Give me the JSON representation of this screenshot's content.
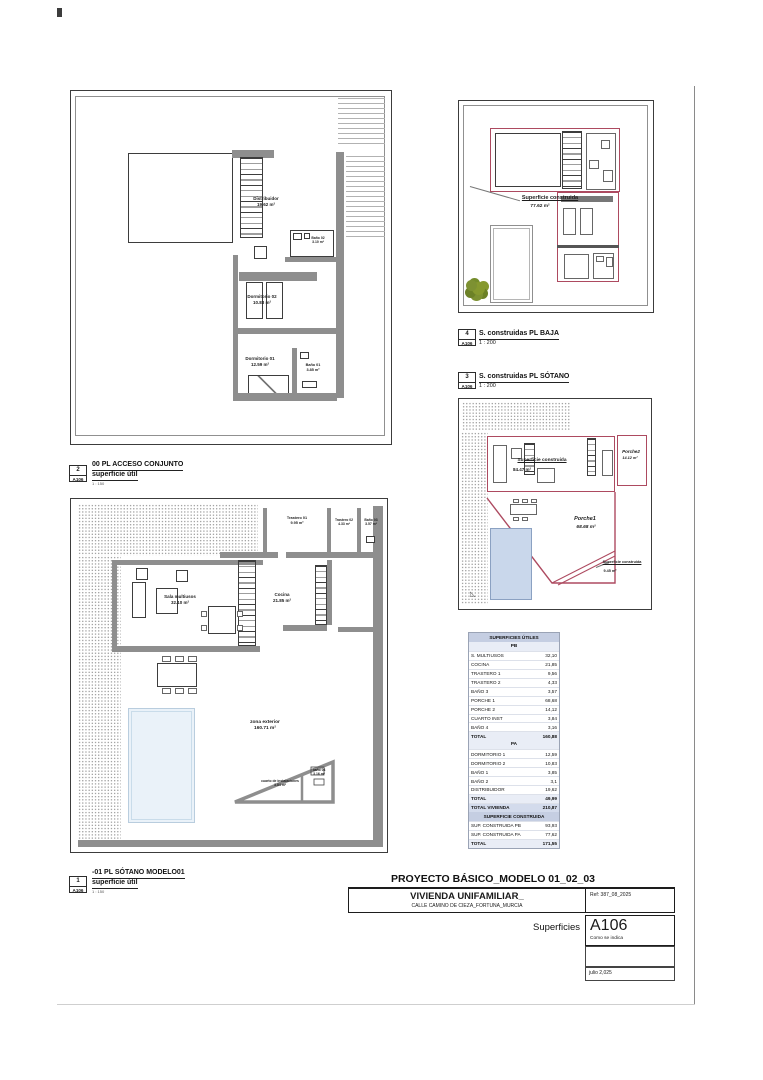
{
  "sheet": {
    "project_title": "PROYECTO BÁSICO_MODELO 01_02_03",
    "building_title": "VIVIENDA UNIFAMILIAR_",
    "address": "CALLE CAMINO DE CIEZA_FORTUNA_MURCIA",
    "reference": "Ref: 387_08_2025",
    "sheet_name": "Superficies",
    "sheet_number": "A106",
    "scale_note": "Como se indica",
    "date": "julio 2,025"
  },
  "view_labels": {
    "acceso": {
      "num": "2",
      "code": "A106",
      "title": "00 PL ACCESO CONJUNTO",
      "sub": "superficie útil",
      "scale": "1 : 150"
    },
    "sotano": {
      "num": "1",
      "code": "A106",
      "title": "-01 PL SÓTANO MODELO01",
      "sub": "superficie útil",
      "scale": "1 : 150"
    },
    "constr_baja": {
      "num": "4",
      "code": "A106",
      "title": "S. construidas PL BAJA",
      "scale": "1 : 200"
    },
    "constr_sotano": {
      "num": "3",
      "code": "A106",
      "title": "S. construidas PL SÓTANO",
      "scale": "1 : 200"
    }
  },
  "plans": {
    "acceso": {
      "rooms": {
        "distribuidor": {
          "name": "Distribuidor",
          "area": "19.62 m²"
        },
        "bano02": {
          "name": "Baño 02",
          "area": "3.10 m²"
        },
        "dormitorio02": {
          "name": "Dormitorio 02",
          "area": "10.83 m²"
        },
        "dormitorio01": {
          "name": "Dormitorio 01",
          "area": "12.59 m²"
        },
        "bano01": {
          "name": "Baño 01",
          "area": "3.85 m²"
        }
      }
    },
    "sotano": {
      "rooms": {
        "trastero01": {
          "name": "Trastero 01",
          "area": "9.95 m²"
        },
        "trastero02": {
          "name": "Trastero 02",
          "area": "4.33 m²"
        },
        "bano03": {
          "name": "Baño 03",
          "area": "3.57 m²"
        },
        "sala": {
          "name": "Sala multiusos",
          "area": "32.10 m²"
        },
        "cocina": {
          "name": "Cocina",
          "area": "21.85 m²"
        },
        "zona_exterior": {
          "name": "zona exterior",
          "area": "160.71 m²"
        },
        "cuarto_inst": {
          "name": "cuarto de instalaciones",
          "area": "3.84 m²"
        },
        "bano04": {
          "name": "baño 04",
          "area": "3.16 m²"
        }
      }
    },
    "baja_construida": {
      "label": "Superficie construida",
      "area": "77.62 m²"
    },
    "sotano_construida": {
      "construida": {
        "name": "Superficie construida",
        "area": "84.47 m²"
      },
      "porche2": {
        "name": "Porche2",
        "area": "14.12 m²"
      },
      "porche1": {
        "name": "Porche1",
        "area": "68.68 m²"
      },
      "construida2": {
        "name": "Superficie construida",
        "area": "9.45 m²"
      }
    }
  },
  "areas_table": {
    "title": "SUPERFICIES ÚTILES",
    "pb_header": "PB",
    "pb_rows": [
      {
        "label": "S. MULTIUSOS",
        "value": "32,10"
      },
      {
        "label": "COCINA",
        "value": "21,85"
      },
      {
        "label": "TRASTERO 1",
        "value": "9,56"
      },
      {
        "label": "TRASTERO 2",
        "value": "4,33"
      },
      {
        "label": "BAÑO 3",
        "value": "3,57"
      },
      {
        "label": "PORCHE 1",
        "value": "68,68"
      },
      {
        "label": "PORCHE 2",
        "value": "14,12"
      },
      {
        "label": "CUARTO INST",
        "value": "3,84"
      },
      {
        "label": "BAÑO 4",
        "value": "3,16"
      }
    ],
    "pb_total": {
      "label": "TOTAL",
      "value": "160,88"
    },
    "pa_header": "PA",
    "pa_rows": [
      {
        "label": "DORMITORIO 1",
        "value": "12,59"
      },
      {
        "label": "DORMITORIO 2",
        "value": "10,83"
      },
      {
        "label": "BAÑO 1",
        "value": "3,85"
      },
      {
        "label": "BAÑO 2",
        "value": "3,1"
      },
      {
        "label": "DISTRIBUIDOR",
        "value": "19,62"
      }
    ],
    "pa_total": {
      "label": "TOTAL",
      "value": "49,99"
    },
    "total_vivienda": {
      "label": "TOTAL VIVIENDA",
      "value": "210,87"
    },
    "constructed_title": "SUPERFICIE CONSTRUIDA",
    "constructed_rows": [
      {
        "label": "SUP. CONSTRUIDA PB",
        "value": "93,93"
      },
      {
        "label": "SUP. CONSTRUIDA PA",
        "value": "77,62"
      }
    ],
    "constructed_total": {
      "label": "TOTAL",
      "value": "171,55"
    }
  },
  "colors": {
    "red_outline": "#ad4a60",
    "wall_gray": "#8e8e8e",
    "pool_fill": "#c9d7eb",
    "pool_light": "#eaf2f9",
    "tree_green": "#7d9132",
    "table_header": "#c5cee2",
    "table_band": "#e9edf6"
  }
}
